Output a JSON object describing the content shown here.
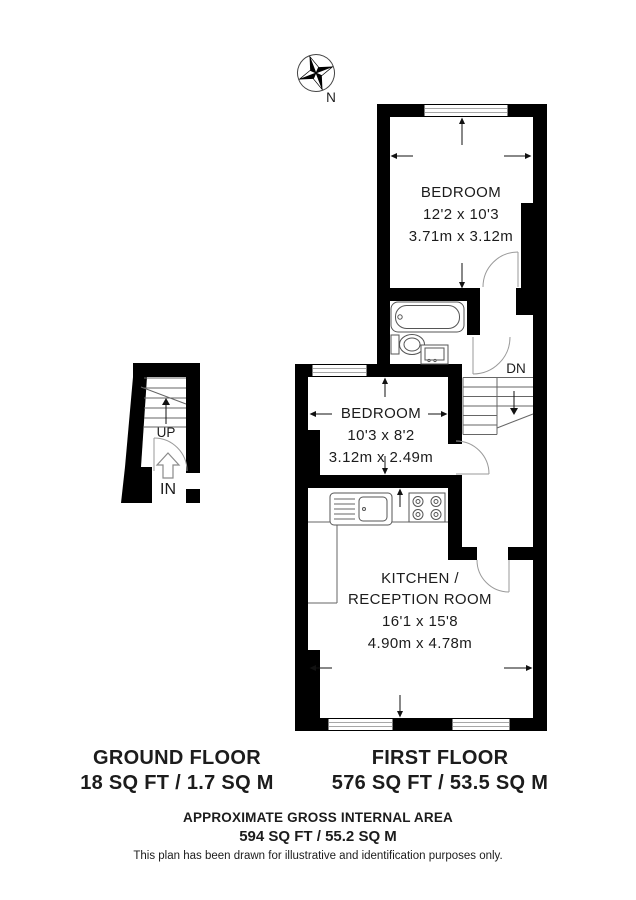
{
  "compass": {
    "north_label": "N"
  },
  "first_floor": {
    "bedroom1": {
      "name": "BEDROOM",
      "imperial": "12'2 x 10'3",
      "metric": "3.71m x 3.12m"
    },
    "bedroom2": {
      "name": "BEDROOM",
      "imperial": "10'3 x 8'2",
      "metric": "3.12m x 2.49m"
    },
    "kitchen": {
      "name_line1": "KITCHEN /",
      "name_line2": "RECEPTION ROOM",
      "imperial": "16'1 x 15'8",
      "metric": "4.90m x 4.78m"
    },
    "stairs_down_label": "DN"
  },
  "ground_floor": {
    "stairs_up_label": "UP",
    "entrance_label": "IN"
  },
  "footer": {
    "ground_floor_title": "GROUND FLOOR",
    "ground_floor_area": "18 SQ FT / 1.7 SQ M",
    "first_floor_title": "FIRST FLOOR",
    "first_floor_area": "576 SQ FT / 53.5 SQ M",
    "summary_title": "APPROXIMATE GROSS INTERNAL AREA",
    "summary_area": "594 SQ FT / 55.2 SQ M",
    "disclaimer": "This plan has been drawn for illustrative and identification purposes only."
  }
}
